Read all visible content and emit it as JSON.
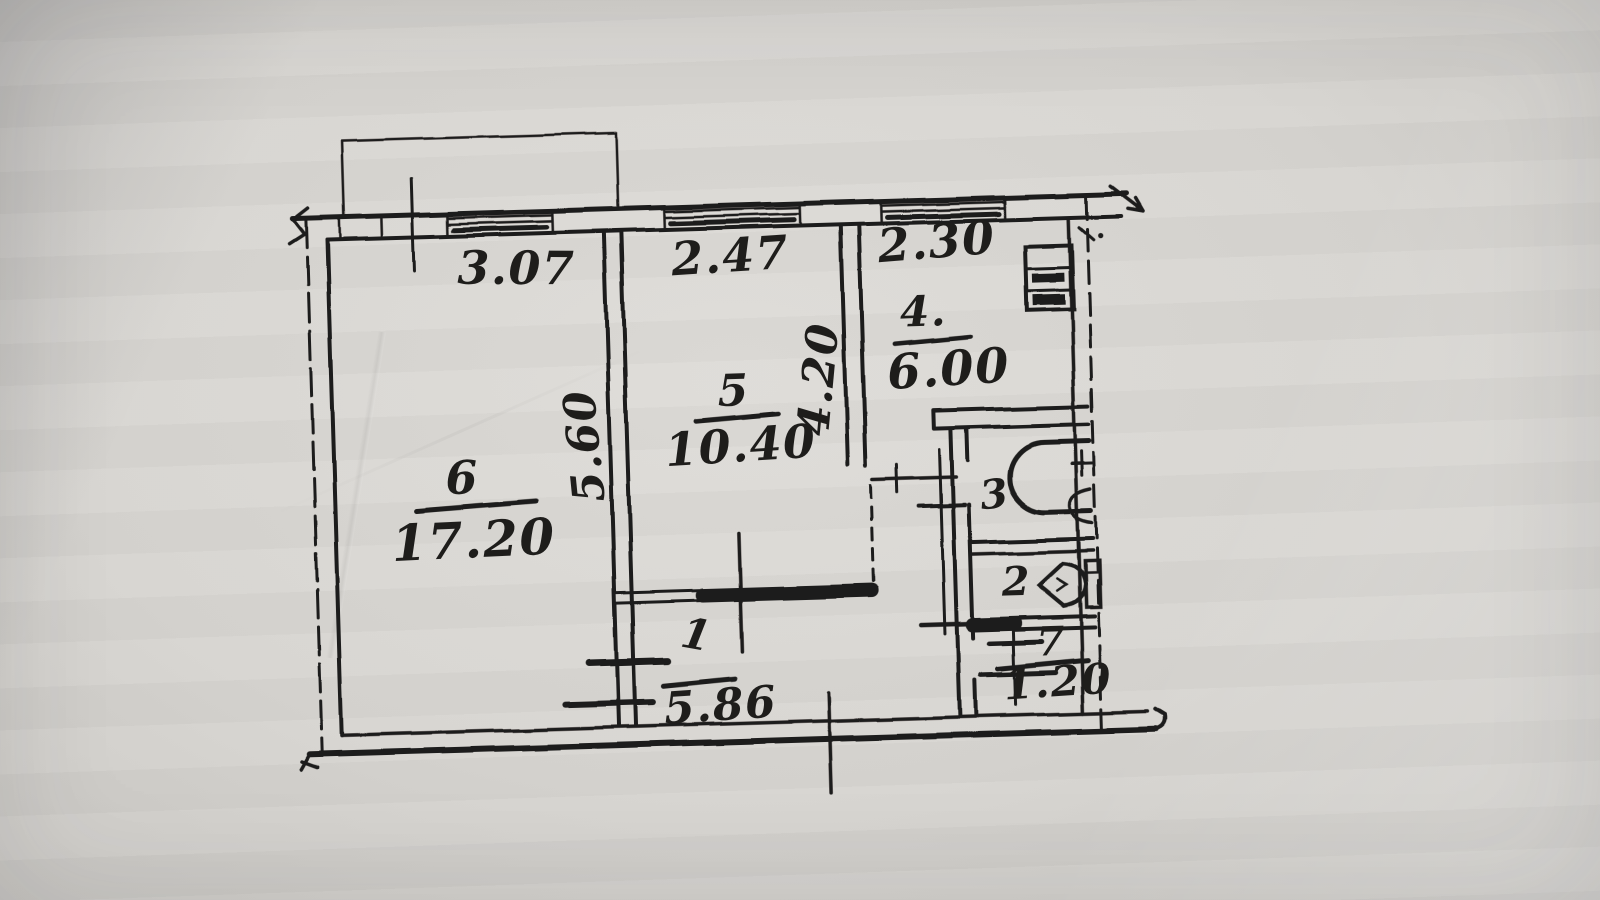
{
  "palette": {
    "paper": "#d7d5d1",
    "ink": "#1e1d1b"
  },
  "plan": {
    "rooms": [
      {
        "number": "6",
        "area": "17.20"
      },
      {
        "number": "5",
        "area": "10.40"
      },
      {
        "number": "4.",
        "area": "6.00"
      },
      {
        "number": "3"
      },
      {
        "number": "2"
      },
      {
        "number": "1",
        "area": "5.86"
      },
      {
        "number": "7",
        "area": "1.20"
      }
    ],
    "dimensions": {
      "room6_width": "3.07",
      "room5_width": "2.47",
      "kitchen_width": "2.30",
      "room6_depth": "5.60",
      "room5_depth": "4.20"
    },
    "fixtures": [
      {
        "icon": "stove-icon",
        "room": "4."
      },
      {
        "icon": "bathtub-icon",
        "room": "3"
      },
      {
        "icon": "sink-icon",
        "room": "3"
      },
      {
        "icon": "toilet-icon",
        "room": "2"
      }
    ]
  }
}
